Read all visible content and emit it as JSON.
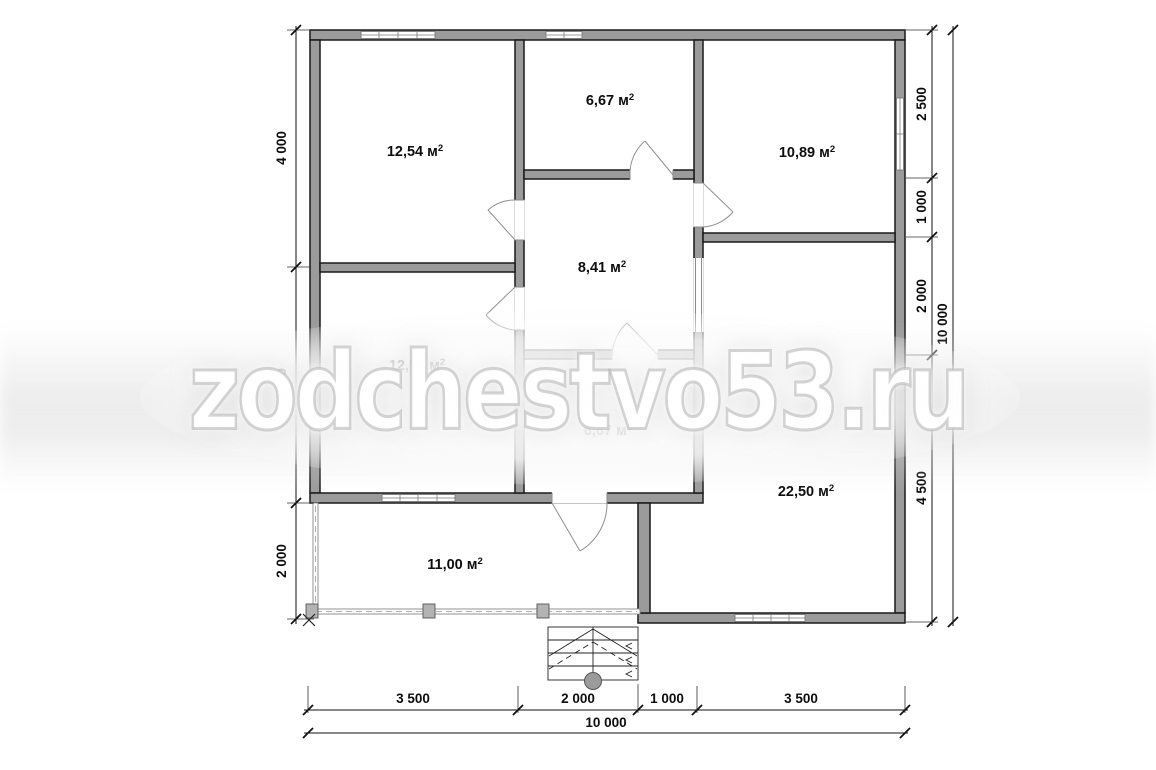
{
  "watermark": {
    "text": "zodchestvo53.ru"
  },
  "area_unit": {
    "base": "м",
    "exp": "2"
  },
  "rooms": [
    {
      "name": "room-top-left",
      "area": "12,54"
    },
    {
      "name": "room-top-center",
      "area": "6,67"
    },
    {
      "name": "room-top-right",
      "area": "10,89"
    },
    {
      "name": "hall-center",
      "area": "8,41"
    },
    {
      "name": "room-mid-left",
      "area": "12,54"
    },
    {
      "name": "room-lower-center",
      "area": "6,67"
    },
    {
      "name": "room-bottom-right",
      "area": "22,50"
    },
    {
      "name": "terrace-bottom-left",
      "area": "11,00"
    }
  ],
  "dimensions": {
    "left": [
      "4 000",
      "4 000",
      "2 000"
    ],
    "right": [
      "2 500",
      "1 000",
      "2 000",
      "4 500"
    ],
    "right_total": "10 000",
    "bottom": [
      "3 500",
      "2 000",
      "1 000",
      "3 500"
    ],
    "bottom_total": "10 000"
  },
  "colors": {
    "wall_fill": "#9b9b9b",
    "wall_stroke": "#1a1a1a",
    "dim_text": "#0d0d0d",
    "door_arc": "#909090",
    "watermark_fill": "#ffffff",
    "watermark_outline": "#aaaaaa"
  }
}
